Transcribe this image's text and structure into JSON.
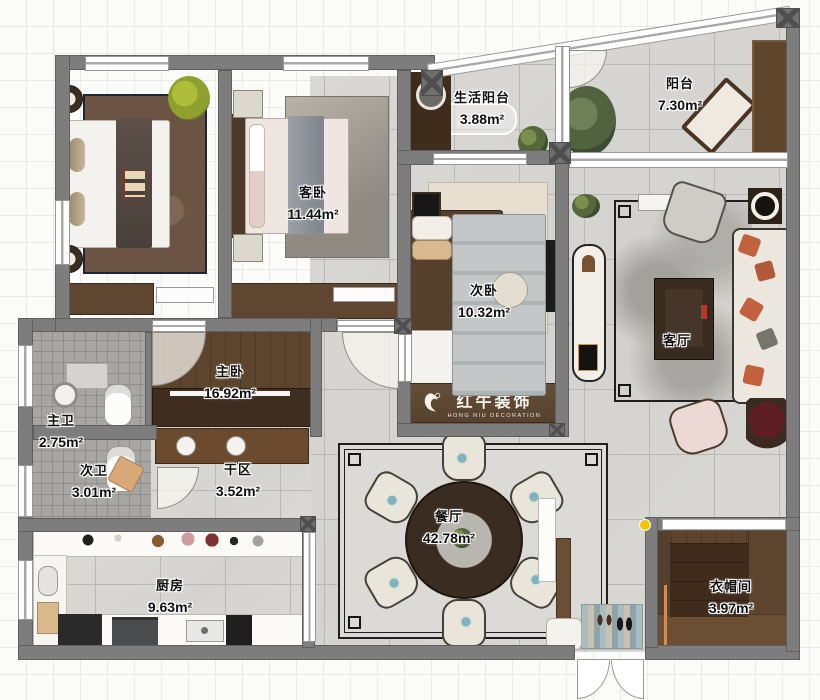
{
  "plan_title": "apartment-floor-plan",
  "brand": {
    "name": "红牛装饰",
    "name_en": "HONG NIU DECORATION",
    "registered_mark": "®"
  },
  "rooms": {
    "living_balcony": {
      "name": "生活阳台",
      "area": "3.88m²"
    },
    "balcony": {
      "name": "阳台",
      "area": "7.30m²"
    },
    "guest_bedroom": {
      "name": "客卧",
      "area": "11.44m²"
    },
    "second_bedroom": {
      "name": "次卧",
      "area": "10.32m²"
    },
    "living_room": {
      "name": "客厅",
      "area": ""
    },
    "master_bedroom": {
      "name": "主卧",
      "area": "16.92m²"
    },
    "master_bath": {
      "name": "主卫",
      "area": "2.75m²"
    },
    "second_bath": {
      "name": "次卫",
      "area": "3.01m²"
    },
    "dry_area": {
      "name": "干区",
      "area": "3.52m²"
    },
    "kitchen": {
      "name": "厨房",
      "area": "9.63m²"
    },
    "dining_room": {
      "name": "餐厅",
      "area": "42.78m²"
    },
    "cloakroom": {
      "name": "衣帽间",
      "area": "3.97m²"
    }
  },
  "palette": {
    "wall": "#7d7d7d",
    "wood_dark": "#48311f",
    "wood_mid": "#5d442c",
    "tile": "#d8d7d3",
    "bath_tile": "#a7a6a3",
    "sofa_accent": "#c2613e",
    "logo_band": "#5a462f",
    "marker_yellow": "#f2c500",
    "grid_line": "#e9e9e9"
  }
}
